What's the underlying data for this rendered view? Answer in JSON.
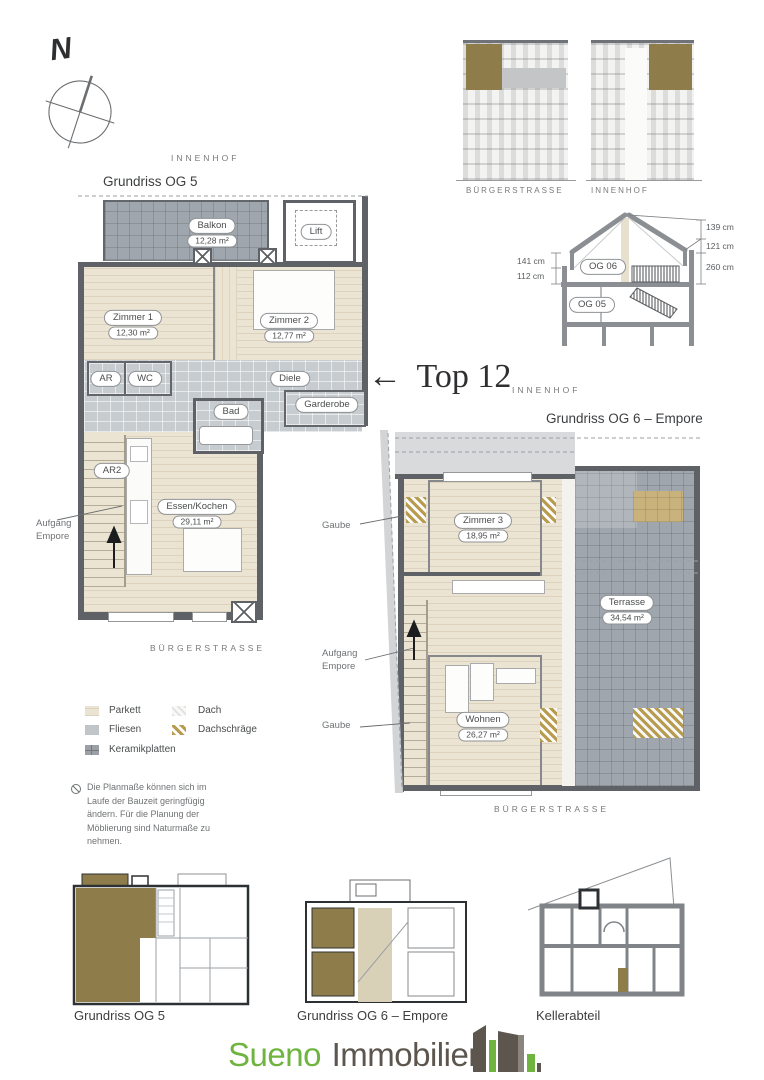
{
  "compass": {
    "label": "N"
  },
  "plan_og5": {
    "context_top": "INNENHOF",
    "title": "Grundriss OG 5",
    "context_bottom": "BÜRGERSTRASSE",
    "stair_label_line1": "Aufgang",
    "stair_label_line2": "Empore",
    "rooms": {
      "balkon": {
        "name": "Balkon",
        "area": "12,28 m²"
      },
      "lift": {
        "name": "Lift"
      },
      "zimmer1": {
        "name": "Zimmer 1",
        "area": "12,30 m²"
      },
      "zimmer2": {
        "name": "Zimmer 2",
        "area": "12,77 m²"
      },
      "ar": {
        "name": "AR"
      },
      "wc": {
        "name": "WC"
      },
      "diele": {
        "name": "Diele"
      },
      "garderobe": {
        "name": "Garderobe"
      },
      "bad": {
        "name": "Bad"
      },
      "ar2": {
        "name": "AR2"
      },
      "essen_kochen": {
        "name": "Essen/Kochen",
        "area": "29,11 m²"
      }
    }
  },
  "plan_og6": {
    "context_top": "INNENHOF",
    "title": "Grundriss OG 6 – Empore",
    "context_bottom": "BÜRGERSTRASSE",
    "gaube_top": "Gaube",
    "gaube_bottom": "Gaube",
    "stair_label_line1": "Aufgang",
    "stair_label_line2": "Empore",
    "rooms": {
      "zimmer3": {
        "name": "Zimmer 3",
        "area": "18,95 m²"
      },
      "terrasse": {
        "name": "Terrasse",
        "area": "34,54 m²"
      },
      "wohnen": {
        "name": "Wohnen",
        "area": "26,27 m²"
      }
    }
  },
  "elevations": {
    "left_caption": "BÜRGERSTRASSE",
    "right_caption": "INNENHOF"
  },
  "section": {
    "dim_right_1": "139 cm",
    "dim_right_2": "121 cm",
    "dim_right_3": "260 cm",
    "dim_left_1": "141 cm",
    "dim_left_2": "112 cm",
    "floor_upper": "OG 06",
    "floor_lower": "OG 05"
  },
  "top_marker": {
    "arrow": "←",
    "label": "Top 12"
  },
  "legend": {
    "parkett": "Parkett",
    "fliesen": "Fliesen",
    "keramikplatten": "Keramikplatten",
    "dach": "Dach",
    "dachschraege": "Dachschräge"
  },
  "note": {
    "text": "Die Planmaße können sich im Laufe der Bauzeit geringfügig ändern. Für die Planung der Möblierung sind Naturmaße zu nehmen."
  },
  "mini_plans": {
    "og5_caption": "Grundriss OG 5",
    "og6_caption": "Grundriss OG 6 – Empore",
    "keller_caption": "Kellerabteil"
  },
  "footer": {
    "brand_primary": "Sueno",
    "brand_secondary": "Immobilien"
  },
  "colors": {
    "accent_green": "#6fb43f",
    "brand_gray": "#5d564e",
    "olive": "#8e7d4b",
    "dachschraege": "#b79c4f",
    "parkett": "#ece4d2",
    "fliesen": "#c7ccd1",
    "terrace": "#9fa6ad",
    "wall": "#5e6266"
  }
}
